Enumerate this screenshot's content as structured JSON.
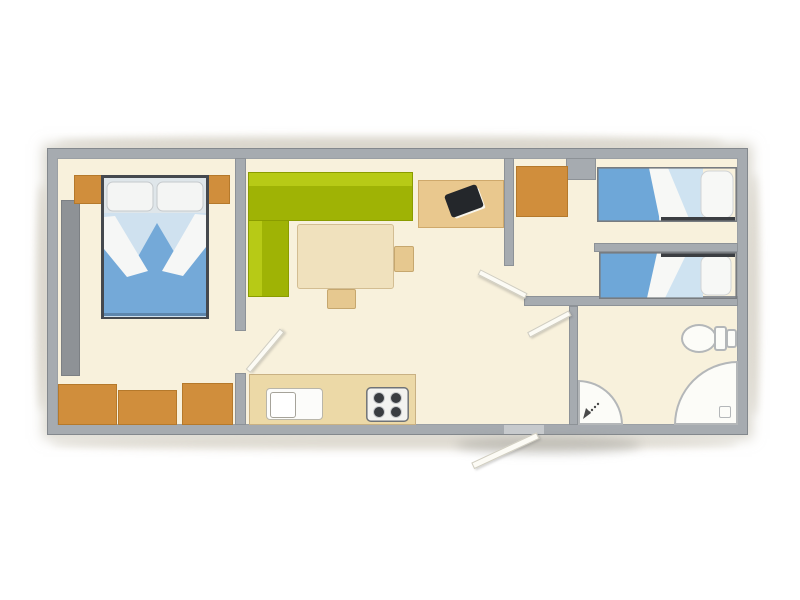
{
  "title": "Mobile home floor plan - 2 bedrooms",
  "palette": {
    "floor": "#f8f1dc",
    "wall": "#a6abb0",
    "wall-edge": "#83888d",
    "orange": "#d08e3c",
    "orange-edge": "#b5792b",
    "green": "#9fb305",
    "green-light": "#b7ca16",
    "tan": "#f0e1bd",
    "tan-edge": "#d3bd92",
    "desk": "#e9c88e",
    "desk-edge": "#cfa96b",
    "counter": "#ecd9a7",
    "blue": "#74a9d8",
    "blue-light": "#cfe2f0",
    "bed-frame-dark": "#45494e",
    "white-fixture": "#fcfcf8",
    "fixture-edge": "#b4b7b9",
    "tv": "#24272b",
    "leaf": "#fcfbf5",
    "leaf-edge": "#d0cdc0"
  },
  "rooms": [
    {
      "id": "bedroom-master",
      "furniture": [
        "double-bed",
        "pillow",
        "pillow",
        "nightstand-left",
        "nightstand-right",
        "gray-wardrobe",
        "cabinet",
        "cabinet",
        "cabinet"
      ]
    },
    {
      "id": "living-kitchen",
      "furniture": [
        "corner-sofa",
        "dining-table",
        "stool-right",
        "stool-bottom",
        "tv-desk",
        "tv",
        "kitchen-counter",
        "sink",
        "stove"
      ]
    },
    {
      "id": "bedroom-twin",
      "furniture": [
        "wardrobe",
        "single-bed-top",
        "single-bed-bottom"
      ]
    },
    {
      "id": "hallway",
      "furniture": []
    },
    {
      "id": "bathroom",
      "furniture": [
        "toilet",
        "corner-shower",
        "corner-basin",
        "shower-head-icon",
        "drain"
      ]
    }
  ],
  "doors": [
    "master-bedroom-door",
    "hallway-door-upper",
    "hallway-door-lower",
    "entrance-door"
  ]
}
